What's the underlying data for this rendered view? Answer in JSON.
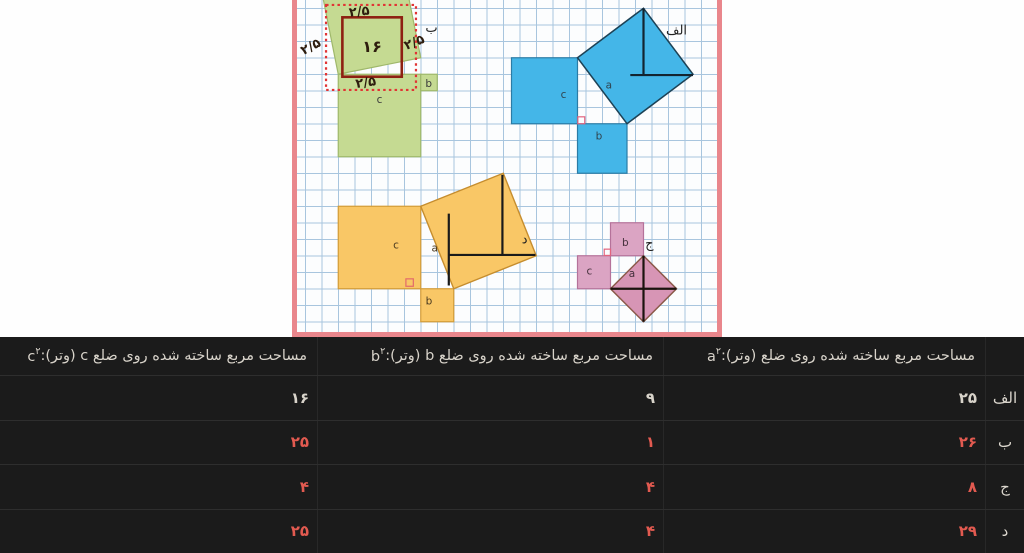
{
  "page": {
    "width": 1024,
    "height": 553,
    "background": "#fefefe"
  },
  "figure": {
    "name": "pythagorean-theorem-grid-figure",
    "frame": {
      "left": 292,
      "top": 0,
      "width": 430,
      "height": 337,
      "border_color": "#e9868c",
      "border_width": 5,
      "paper_color": "#fcfdfe",
      "grid_color": "#a8c5de",
      "unit": 16.5,
      "grid_offset": 8.25
    },
    "squares": [
      {
        "name": "square-c-green",
        "x": 2.5,
        "y": 4.5,
        "w": 5,
        "h": 5,
        "fill": "#c5da92",
        "stroke": "#9fb86b"
      },
      {
        "name": "square-b-green",
        "x": 7.5,
        "y": 4.5,
        "w": 1,
        "h": 1,
        "fill": "#c5da92",
        "stroke": "#9fb86b"
      },
      {
        "name": "square-c-blue",
        "x": 13,
        "y": 3.5,
        "w": 4,
        "h": 4,
        "fill": "#44b6e8",
        "stroke": "#2b7ca6"
      },
      {
        "name": "square-b-blue",
        "x": 17,
        "y": 7.5,
        "w": 3,
        "h": 3,
        "fill": "#44b6e8",
        "stroke": "#2b7ca6"
      },
      {
        "name": "square-c-orange",
        "x": 2.5,
        "y": 12.5,
        "w": 5,
        "h": 5,
        "fill": "#f9c766",
        "stroke": "#d39c38"
      },
      {
        "name": "square-b-orange",
        "x": 7.5,
        "y": 17.5,
        "w": 2,
        "h": 2,
        "fill": "#f9c766",
        "stroke": "#d39c38"
      },
      {
        "name": "square-b-pink",
        "x": 19,
        "y": 13.5,
        "w": 2,
        "h": 2,
        "fill": "#dba4c3",
        "stroke": "#b5729a"
      },
      {
        "name": "square-c-pink",
        "x": 17,
        "y": 15.5,
        "w": 2,
        "h": 2,
        "fill": "#dba4c3",
        "stroke": "#b5729a"
      }
    ],
    "tilted_squares": [
      {
        "name": "square-a-green-tilted",
        "pts": [
          [
            2.5,
            4.5
          ],
          [
            7.5,
            3.5
          ],
          [
            6.5,
            -1.5
          ],
          [
            1.5,
            -0.5
          ]
        ],
        "fill": "#c5da92",
        "stroke": "#9fb86b",
        "sw": 1.2
      },
      {
        "name": "square-a-blue-tilted",
        "pts": [
          [
            17,
            3.5
          ],
          [
            21,
            0.5
          ],
          [
            24,
            4.5
          ],
          [
            20,
            7.5
          ]
        ],
        "fill": "#44b6e8",
        "stroke": "#1d4256",
        "sw": 1.5
      },
      {
        "name": "square-a-orange-tilted",
        "pts": [
          [
            7.5,
            12.5
          ],
          [
            12.5,
            10.5
          ],
          [
            14.5,
            15.5
          ],
          [
            9.5,
            17.5
          ]
        ],
        "fill": "#f9c766",
        "stroke": "#c68d2e",
        "sw": 1.4
      },
      {
        "name": "square-a-pink-diamond",
        "pts": [
          [
            19,
            17.5
          ],
          [
            21,
            15.5
          ],
          [
            23,
            17.5
          ],
          [
            21,
            19.5
          ]
        ],
        "fill": "#d795b5",
        "stroke": "#8a5848",
        "sw": 1.5
      }
    ],
    "segments": [
      {
        "name": "blue-inner-line",
        "x1": 21,
        "y1": 0.5,
        "x2": 21,
        "y2": 4.55,
        "stroke": "#132430",
        "sw": 2.2
      },
      {
        "name": "blue-inner-line",
        "x1": 20.2,
        "y1": 4.55,
        "x2": 24,
        "y2": 4.55,
        "stroke": "#132430",
        "sw": 2.2
      },
      {
        "name": "orange-inner-line",
        "x1": 9.2,
        "y1": 12.95,
        "x2": 9.2,
        "y2": 17.3,
        "stroke": "#1a1a1a",
        "sw": 2.2
      },
      {
        "name": "orange-inner-line",
        "x1": 9.2,
        "y1": 15.45,
        "x2": 14.45,
        "y2": 15.45,
        "stroke": "#1a1a1a",
        "sw": 2.2
      },
      {
        "name": "orange-inner-line",
        "x1": 12.45,
        "y1": 10.6,
        "x2": 12.45,
        "y2": 15.45,
        "stroke": "#1a1a1a",
        "sw": 2.2
      },
      {
        "name": "pink-diagonal-line",
        "x1": 19,
        "y1": 17.5,
        "x2": 23,
        "y2": 17.5,
        "stroke": "#1b130e",
        "sw": 2.2
      },
      {
        "name": "pink-diagonal-line",
        "x1": 21,
        "y1": 15.5,
        "x2": 21,
        "y2": 19.5,
        "stroke": "#1b130e",
        "sw": 2.2
      }
    ],
    "outline_overlays": [
      {
        "name": "inner-square-16-outline",
        "x": 2.75,
        "y": 1.05,
        "w": 3.6,
        "h": 3.6,
        "stroke": "#8e2012",
        "sw": 2.6,
        "dash": ""
      },
      {
        "name": "dashed-bounding-box",
        "x": 1.76,
        "y": 0.3,
        "w": 5.45,
        "h": 5.15,
        "stroke": "#e13434",
        "sw": 2.2,
        "dash": "2.5 3.2"
      }
    ],
    "markers": [
      {
        "name": "right-angle-marker-blue",
        "x": 17.02,
        "y": 7.08,
        "w": 0.42,
        "h": 0.42,
        "stroke": "#e2647e"
      },
      {
        "name": "right-angle-marker-orange",
        "x": 6.6,
        "y": 16.9,
        "w": 0.45,
        "h": 0.45,
        "stroke": "#e36a6a"
      },
      {
        "name": "right-angle-marker-pink",
        "x": 18.62,
        "y": 15.1,
        "w": 0.38,
        "h": 0.38,
        "stroke": "#e2647e"
      }
    ],
    "labels": [
      {
        "name": "handwritten-16",
        "text": "۱۶",
        "x": 4.55,
        "y": 3.15,
        "size": 16,
        "color": "#2e1d0e",
        "bold": true,
        "rot": 0
      },
      {
        "name": "handwritten-2.5-top",
        "text": "۲/۵",
        "x": 3.8,
        "y": 0.95,
        "size": 13,
        "color": "#2e1d0e",
        "bold": true,
        "rot": -6
      },
      {
        "name": "handwritten-2.5-left",
        "text": "۲/۵",
        "x": 0.95,
        "y": 3.05,
        "size": 13,
        "color": "#2e1d0e",
        "bold": true,
        "rot": -28
      },
      {
        "name": "handwritten-2.5-right",
        "text": "۲/۵",
        "x": 7.2,
        "y": 2.8,
        "size": 13,
        "color": "#2e1d0e",
        "bold": true,
        "rot": -22
      },
      {
        "name": "handwritten-2.5-bottom",
        "text": "۲/۵",
        "x": 4.2,
        "y": 5.25,
        "size": 13,
        "color": "#2e1d0e",
        "bold": true,
        "rot": -8
      },
      {
        "name": "figure-label-be",
        "text": "ب",
        "x": 8.15,
        "y": 1.95,
        "size": 13,
        "color": "#222222",
        "bold": false,
        "rot": 0
      },
      {
        "name": "figure-label-alef",
        "text": "الف",
        "x": 23.0,
        "y": 2.1,
        "size": 13,
        "color": "#222222",
        "bold": false,
        "rot": 0
      },
      {
        "name": "figure-label-dal",
        "text": "د",
        "x": 13.8,
        "y": 14.75,
        "size": 13,
        "color": "#222222",
        "bold": false,
        "rot": 0
      },
      {
        "name": "figure-label-jim",
        "text": "ج",
        "x": 21.35,
        "y": 15.0,
        "size": 13,
        "color": "#222222",
        "bold": false,
        "rot": 0
      },
      {
        "name": "label-c-green",
        "text": "c",
        "x": 5.0,
        "y": 6.25,
        "size": 10.5,
        "color": "#3b3b3b",
        "bold": false,
        "rot": 0
      },
      {
        "name": "label-b-green",
        "text": "b",
        "x": 7.98,
        "y": 5.28,
        "size": 10.5,
        "color": "#3b3b3b",
        "bold": false,
        "rot": 0
      },
      {
        "name": "label-c-blue",
        "text": "c",
        "x": 16.15,
        "y": 5.95,
        "size": 10.5,
        "color": "#30444f",
        "bold": false,
        "rot": 0
      },
      {
        "name": "label-a-blue",
        "text": "a",
        "x": 18.9,
        "y": 5.35,
        "size": 10.5,
        "color": "#30444f",
        "bold": false,
        "rot": 0
      },
      {
        "name": "label-b-blue",
        "text": "b",
        "x": 18.3,
        "y": 8.45,
        "size": 10.5,
        "color": "#30444f",
        "bold": false,
        "rot": 0
      },
      {
        "name": "label-c-orange",
        "text": "c",
        "x": 6.0,
        "y": 15.05,
        "size": 10.5,
        "color": "#4a3a20",
        "bold": false,
        "rot": 0
      },
      {
        "name": "label-a-orange",
        "text": "a",
        "x": 8.35,
        "y": 15.25,
        "size": 10.5,
        "color": "#4a3a20",
        "bold": false,
        "rot": 0
      },
      {
        "name": "label-b-orange",
        "text": "b",
        "x": 8.0,
        "y": 18.45,
        "size": 10.5,
        "color": "#4a3a20",
        "bold": false,
        "rot": 0
      },
      {
        "name": "label-b-pink",
        "text": "b",
        "x": 19.9,
        "y": 14.9,
        "size": 10.5,
        "color": "#45303c",
        "bold": false,
        "rot": 0
      },
      {
        "name": "label-c-pink",
        "text": "c",
        "x": 17.72,
        "y": 16.65,
        "size": 10.5,
        "color": "#45303c",
        "bold": false,
        "rot": 0
      },
      {
        "name": "label-a-pink",
        "text": "a",
        "x": 20.3,
        "y": 16.8,
        "size": 10.5,
        "color": "#45303c",
        "bold": false,
        "rot": 0
      }
    ]
  },
  "table": {
    "name": "areas-table",
    "background": "#1b1b1b",
    "header_text_color": "#d8d3ca",
    "value_color": "#d8d3ca",
    "answer_color": "#e25a50",
    "columns": [
      {
        "id": "a",
        "header": "مساحت مربع ساخته شده روی ضلع (وتر): ",
        "symbol": "a",
        "sup": "۲"
      },
      {
        "id": "b",
        "header": "مساحت مربع ساخته شده روی ضلع b (وتر): ",
        "symbol": "b",
        "sup": "۲"
      },
      {
        "id": "c",
        "header": "مساحت مربع ساخته شده روی ضلع c (وتر): ",
        "symbol": "c",
        "sup": "۲"
      }
    ],
    "rows": [
      {
        "id": "alef",
        "label": "الف",
        "values": {
          "a": "۲۵",
          "b": "۹",
          "c": "۱۶"
        },
        "answer": false
      },
      {
        "id": "be",
        "label": "ب",
        "values": {
          "a": "۲۶",
          "b": "۱",
          "c": "۲۵"
        },
        "answer": true
      },
      {
        "id": "jim",
        "label": "ج",
        "values": {
          "a": "۸",
          "b": "۴",
          "c": "۴"
        },
        "answer": true
      },
      {
        "id": "dal",
        "label": "د",
        "values": {
          "a": "۲۹",
          "b": "۴",
          "c": "۲۵"
        },
        "answer": true
      }
    ]
  }
}
